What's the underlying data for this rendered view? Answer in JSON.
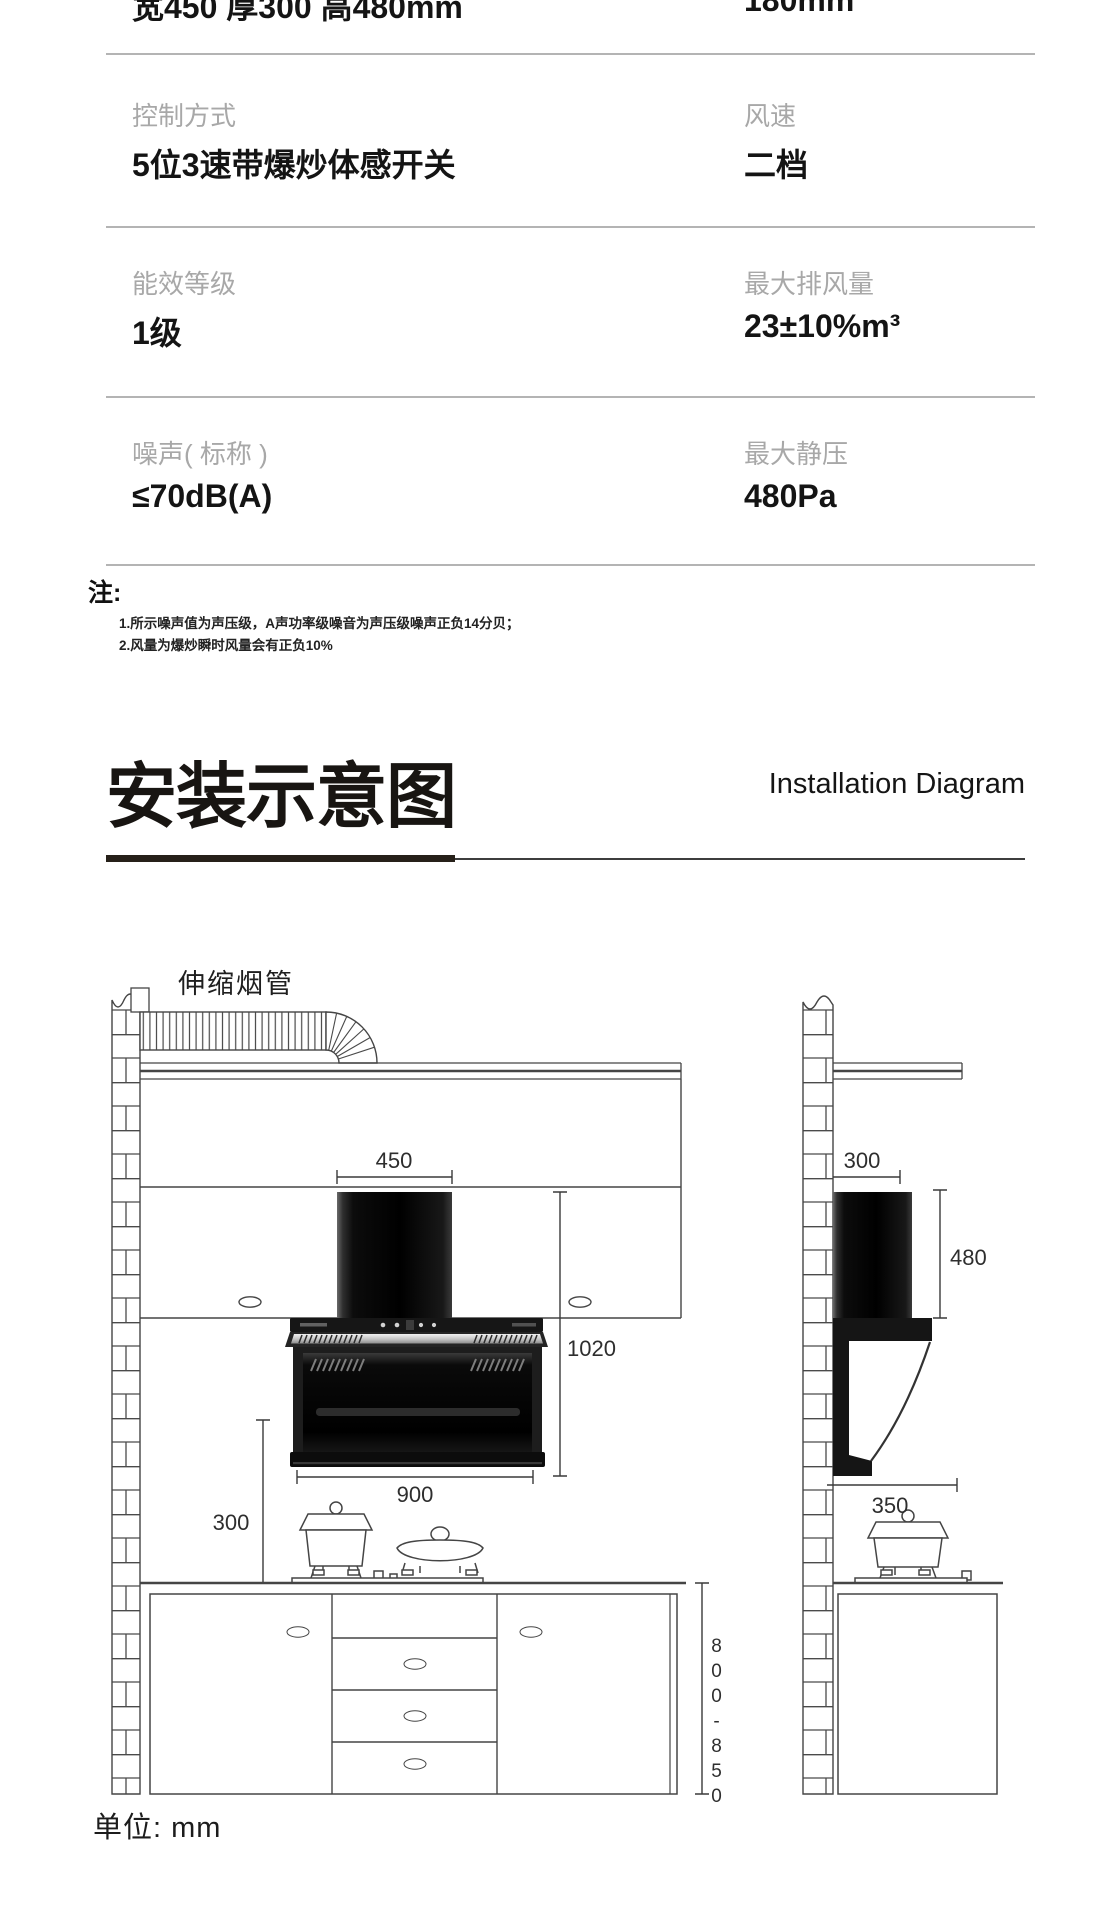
{
  "spec_table": {
    "rows": [
      {
        "left_label": "",
        "left_value": "宽450 厚300 高480mm",
        "right_label": "",
        "right_value": "180mm"
      },
      {
        "left_label": "控制方式",
        "left_value": "5位3速带爆炒体感开关",
        "right_label": "风速",
        "right_value": "二档"
      },
      {
        "left_label": "能效等级",
        "left_value": "1级",
        "right_label": "最大排风量",
        "right_value": "23±10%m³"
      },
      {
        "left_label": "噪声( 标称 )",
        "left_value": "≤70dB(A)",
        "right_label": "最大静压",
        "right_value": "480Pa"
      }
    ],
    "note_title": "注:",
    "notes": [
      "1.所示噪声值为声压级，A声功率级噪音为声压级噪声正负14分贝；",
      "2.风量为爆炒瞬时风量会有正负10%"
    ]
  },
  "section_header": {
    "title_cn": "安装示意图",
    "title_en": "Installation Diagram"
  },
  "diagram": {
    "flue_label": "伸缩烟管",
    "unit_label": "单位: mm",
    "dims": {
      "hood_top_width": "450",
      "chimney_height": "1020",
      "hood_body_width": "900",
      "hood_to_counter": "300",
      "side_top_depth": "300",
      "side_height": "480",
      "side_bottom_depth": "350",
      "counter_height": "800-850"
    }
  },
  "colors": {
    "line": "#454545",
    "dim_text": "#2e2e2e",
    "label_gray": "#a8a8a8",
    "value_black": "#141414",
    "hood_black": "#0a0a0a"
  }
}
